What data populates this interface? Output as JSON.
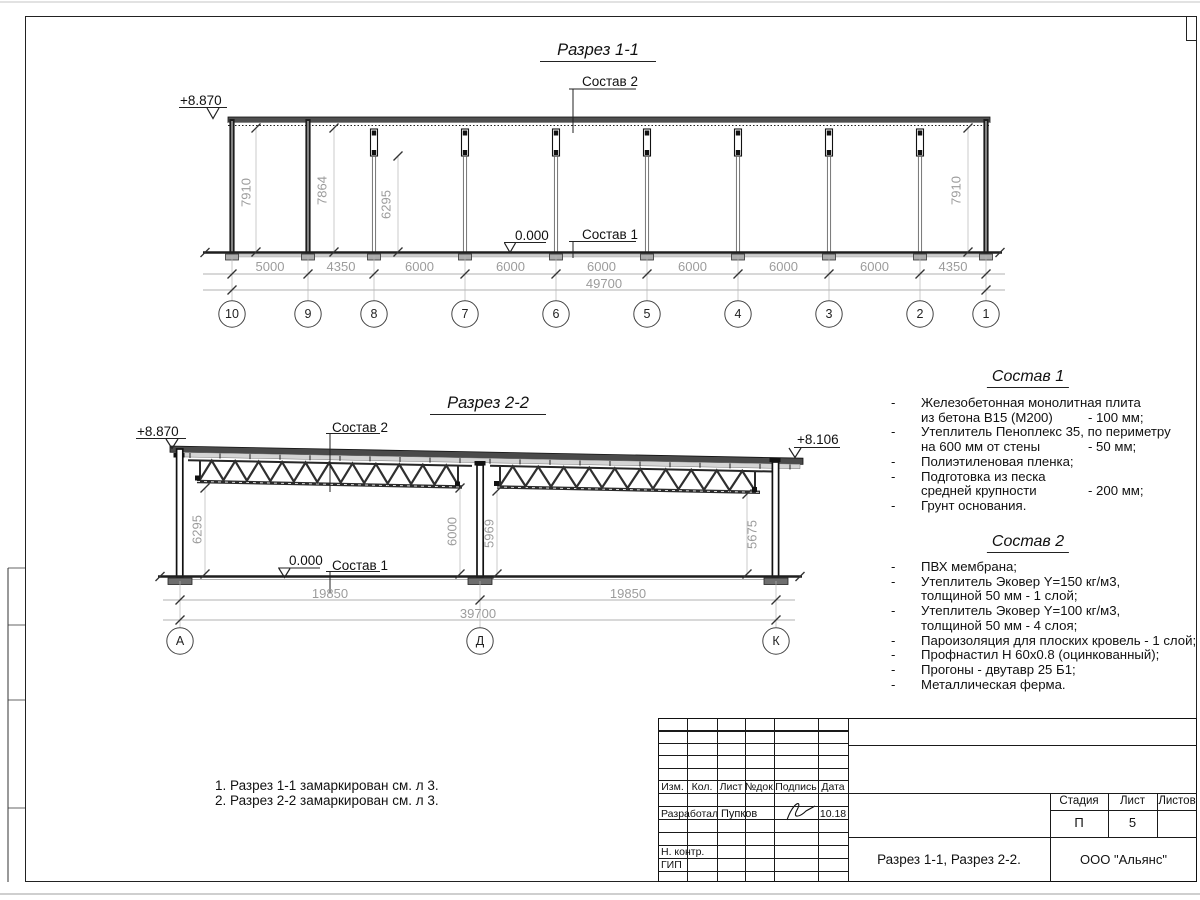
{
  "section_1_1": {
    "title": "Разрез 1-1",
    "elevation": "+8.870",
    "zero_level": "0.000",
    "callout_roof": "Состав 2",
    "callout_floor": "Состав 1",
    "span_dims": [
      "5000",
      "4350",
      "6000",
      "6000",
      "6000",
      "6000",
      "6000",
      "6000",
      "4350"
    ],
    "total_dim": "49700",
    "height_dims": [
      "7910",
      "7864",
      "6295",
      "7910"
    ],
    "grid_labels": [
      "10",
      "9",
      "8",
      "7",
      "6",
      "5",
      "4",
      "3",
      "2",
      "1"
    ]
  },
  "section_2_2": {
    "title": "Разрез 2-2",
    "elevation_left": "+8.870",
    "elevation_right": "+8.106",
    "zero_level": "0.000",
    "callout_roof": "Состав 2",
    "callout_floor": "Состав 1",
    "span_dims": [
      "19850",
      "19850"
    ],
    "total_dim": "39700",
    "height_dims": [
      "6295",
      "6000",
      "5969",
      "5675"
    ],
    "grid_labels": [
      "А",
      "Д",
      "К"
    ]
  },
  "sostav1": {
    "title": "Состав 1",
    "items": [
      {
        "lines": [
          {
            "text": "Железобетонная  монолитная плита",
            "value": ""
          },
          {
            "text": "из бетона В15 (М200)",
            "value": "- 100 мм;"
          }
        ]
      },
      {
        "lines": [
          {
            "text": "Утеплитель Пеноплекс 35, по периметру",
            "value": ""
          },
          {
            "text": "на 600 мм от стены",
            "value": "- 50 мм;"
          }
        ]
      },
      {
        "lines": [
          {
            "text": "Полиэтиленовая пленка;",
            "value": ""
          }
        ]
      },
      {
        "lines": [
          {
            "text": "Подготовка из песка",
            "value": ""
          },
          {
            "text": "средней крупности",
            "value": "- 200 мм;"
          }
        ]
      },
      {
        "lines": [
          {
            "text": "Грунт основания.",
            "value": ""
          }
        ]
      }
    ]
  },
  "sostav2": {
    "title": "Состав 2",
    "items": [
      {
        "lines": [
          {
            "text": "ПВХ мембрана;",
            "value": ""
          }
        ]
      },
      {
        "lines": [
          {
            "text": "Утеплитель Эковер Y=150 кг/м3,",
            "value": ""
          },
          {
            "text": "толщиной 50 мм - 1 слой;",
            "value": ""
          }
        ]
      },
      {
        "lines": [
          {
            "text": "Утеплитель Эковер Y=100 кг/м3,",
            "value": ""
          },
          {
            "text": "толщиной 50 мм - 4 слоя;",
            "value": ""
          }
        ]
      },
      {
        "lines": [
          {
            "text": "Пароизоляция для плоских кровель - 1 слой;",
            "value": ""
          }
        ]
      },
      {
        "lines": [
          {
            "text": "Профнастил Н 60х0.8 (оцинкованный);",
            "value": ""
          }
        ]
      },
      {
        "lines": [
          {
            "text": "Прогоны - двутавр 25 Б1;",
            "value": ""
          }
        ]
      },
      {
        "lines": [
          {
            "text": "Металлическая ферма.",
            "value": ""
          }
        ]
      }
    ]
  },
  "notes": [
    "1. Разрез 1-1 замаркирован см. л 3.",
    "2. Разрез 2-2 замаркирован см. л 3."
  ],
  "title_block": {
    "col_headers": [
      "Изм.",
      "Кол.",
      "Лист",
      "№док.",
      "Подпись",
      "Дата"
    ],
    "developer_label": "Разработал",
    "developer_name": "Пупков",
    "date": "10.18",
    "norm_control_label": "Н. контр.",
    "gip_label": "ГИП",
    "stage_label": "Стадия",
    "sheet_label": "Лист",
    "sheets_label": "Листов",
    "stage_value": "П",
    "sheet_value": "5",
    "doc_title": "Разрез 1-1, Разрез 2-2.",
    "company": "ООО \"Альянс\""
  }
}
